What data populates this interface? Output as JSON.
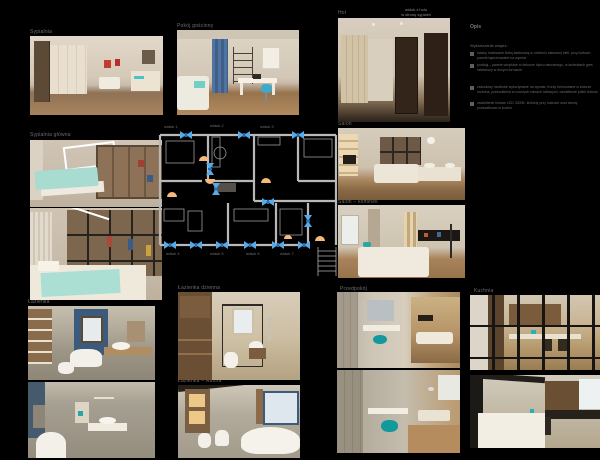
{
  "colors": {
    "background": "#000000",
    "camera_marker_blue": "#57a9e8",
    "door_arc_orange": "#f5b97e",
    "plan_wall_gray": "#b8b8b8",
    "label_gray": "#6e6e6e",
    "accent_teal": "#1fa3a3"
  },
  "labels": {
    "top_left": "Sypialnia",
    "top_mid": "Pokój gościnny",
    "top_right": "Hol",
    "top_right_note_1": "widok z holu",
    "top_right_note_2": "w stronę sypialni",
    "mid_left": "Sypialnia główna",
    "mid_right_1": "Salon",
    "mid_right_2": "Salon – kominek",
    "bottom_left": "Łazienka",
    "bottom_mid_1": "Łazienka dzienna",
    "bottom_mid_2": "Łazienka – wanna",
    "bottom_center": "Przedpokój",
    "bottom_right": "Kuchnia"
  },
  "plan": {
    "views_top": [
      "widok 1",
      "widok 2",
      "widok 3"
    ],
    "views_bottom": [
      "widok 4",
      "widok 5",
      "widok 6",
      "widok 7"
    ]
  },
  "legend": {
    "title": "Opis",
    "heading": "Wykończenie wnętrz:",
    "items": [
      {
        "text": "ściany malowane farbą lateksową w odcieniu złamanej bieli, przy łóżkach panele tapicerowane na wymiar"
      },
      {
        "text": "podłogi – panele winylowe w dekorze dębu naturalnego, w łazienkach gres szkliwiony w dużym formacie"
      },
      {
        "text": "zabudowy meblowe wykonywane na wymiar, fronty fornirowane w kolorze orzecha, przeszklenia w czarnych ramach loftowych, oświetlenie półek liniowe"
      },
      {
        "text": "oświetlenie liniowe LED 3000K, kinkiety przy lustrach oraz taśmy podszafkowe w kuchni"
      }
    ]
  }
}
